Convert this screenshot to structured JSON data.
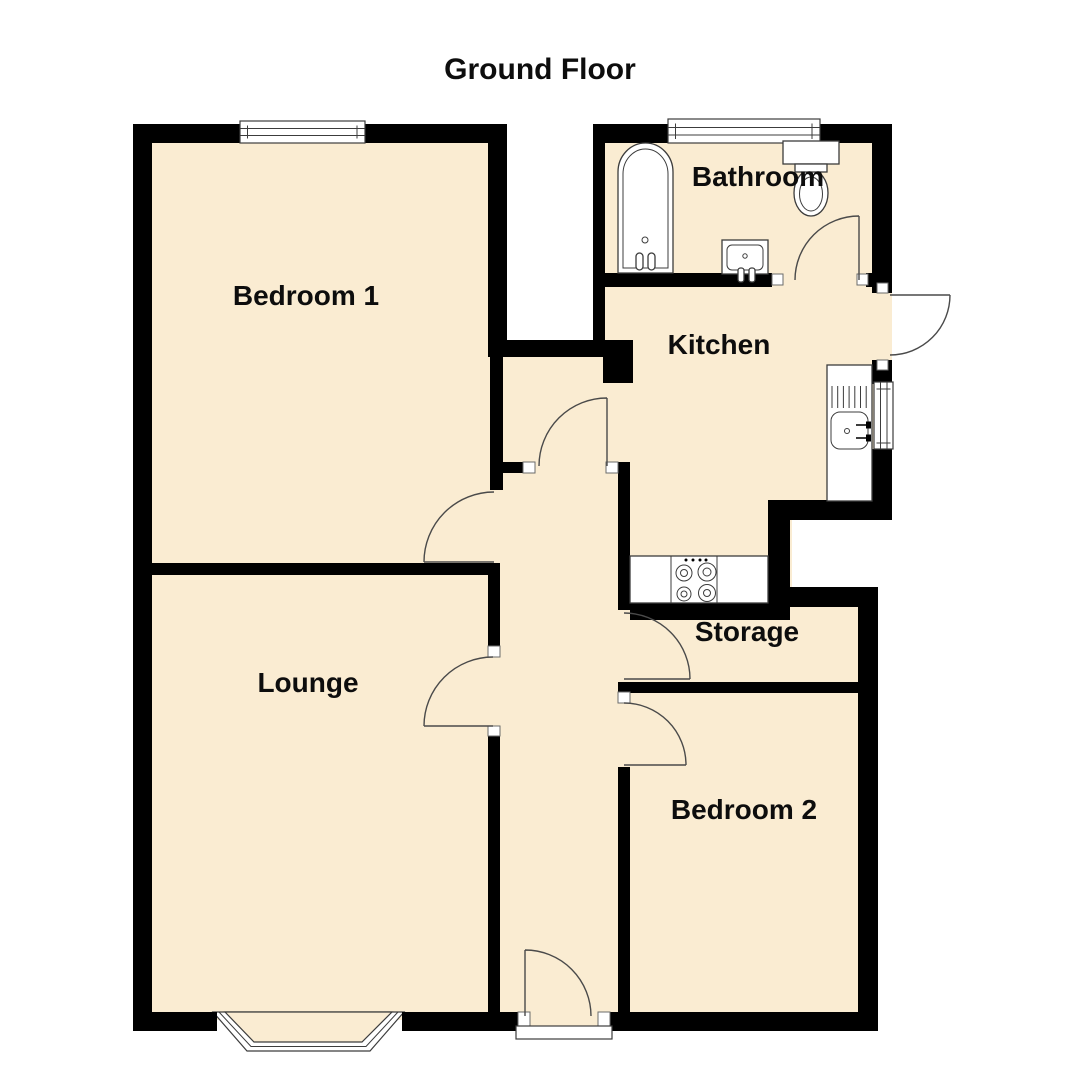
{
  "title": "Ground Floor",
  "rooms": [
    {
      "id": "bedroom1",
      "label": "Bedroom 1"
    },
    {
      "id": "bathroom",
      "label": "Bathroom"
    },
    {
      "id": "kitchen",
      "label": "Kitchen"
    },
    {
      "id": "lounge",
      "label": "Lounge"
    },
    {
      "id": "storage",
      "label": "Storage"
    },
    {
      "id": "bedroom2",
      "label": "Bedroom 2"
    }
  ],
  "colors": {
    "floor_fill": "#faecd2",
    "wall": "#000000",
    "door_line": "#4a4a4a",
    "background": "#ffffff"
  },
  "fixtures": [
    "bathtub",
    "toilet",
    "bathroom-basin",
    "bathroom-window",
    "bedroom1-window",
    "kitchen-sink-counter",
    "kitchen-window",
    "hob",
    "bay-window",
    "front-door-threshold"
  ],
  "doors": [
    "bedroom1-door",
    "kitchen-door",
    "lounge-door",
    "front-door",
    "bathroom-door",
    "back-door",
    "storage-door",
    "bedroom2-door"
  ]
}
